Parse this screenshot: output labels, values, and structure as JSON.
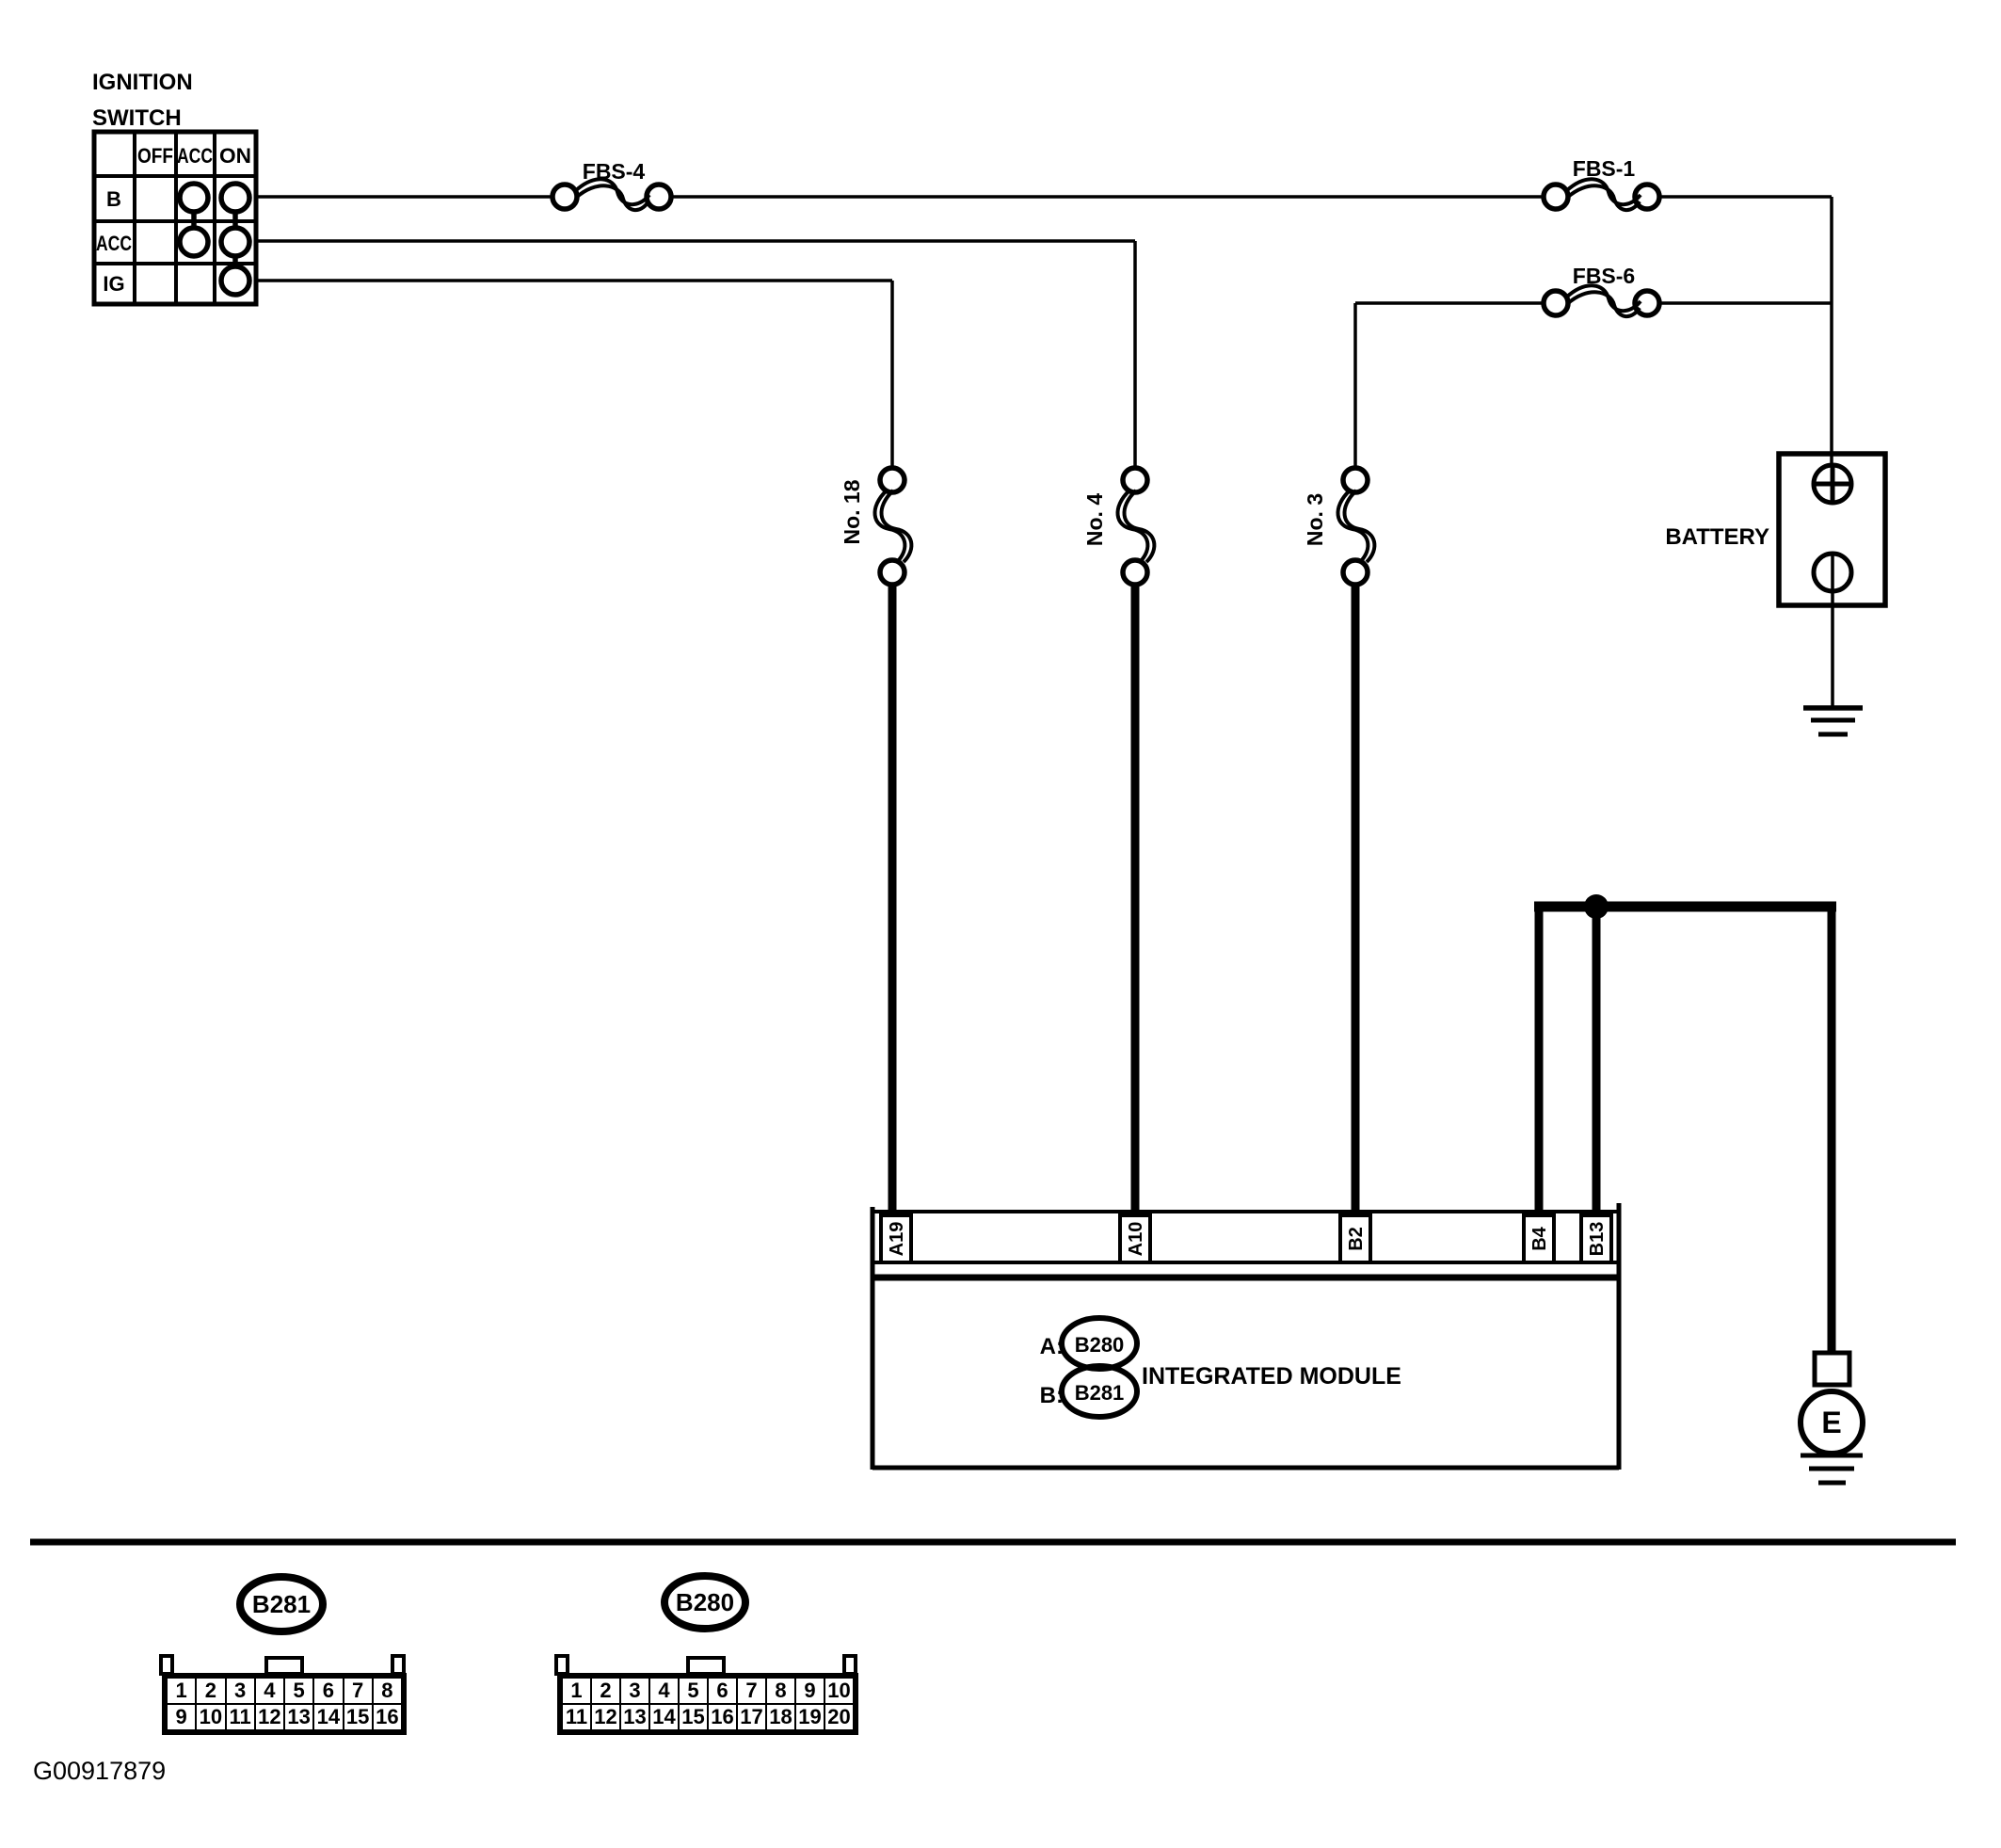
{
  "colors": {
    "ink": "#000000",
    "paper": "#ffffff"
  },
  "ignition_switch": {
    "title_line1": "IGNITION",
    "title_line2": "SWITCH",
    "columns": [
      "OFF",
      "ACC",
      "ON"
    ],
    "rows": [
      "B",
      "ACC",
      "IG"
    ]
  },
  "fuses": {
    "fbs4": "FBS-4",
    "fbs1": "FBS-1",
    "fbs6": "FBS-6",
    "no18": "No. 18",
    "no4": "No. 4",
    "no3": "No. 3"
  },
  "battery": {
    "label": "BATTERY"
  },
  "module": {
    "label": "INTEGRATED MODULE",
    "a_prefix": "A:",
    "a_ref": "B280",
    "b_prefix": "B:",
    "b_ref": "B281",
    "pins": [
      "A19",
      "A10",
      "B2",
      "B4",
      "B13"
    ]
  },
  "lamp": {
    "label": "E"
  },
  "bottom_connectors": [
    {
      "id": "B281",
      "rows": [
        [
          "1",
          "2",
          "3",
          "4",
          "5",
          "6",
          "7",
          "8"
        ],
        [
          "9",
          "10",
          "11",
          "12",
          "13",
          "14",
          "15",
          "16"
        ]
      ]
    },
    {
      "id": "B280",
      "rows": [
        [
          "1",
          "2",
          "3",
          "4",
          "5",
          "6",
          "7",
          "8",
          "9",
          "10"
        ],
        [
          "11",
          "12",
          "13",
          "14",
          "15",
          "16",
          "17",
          "18",
          "19",
          "20"
        ]
      ]
    }
  ],
  "figure_id": "G00917879"
}
